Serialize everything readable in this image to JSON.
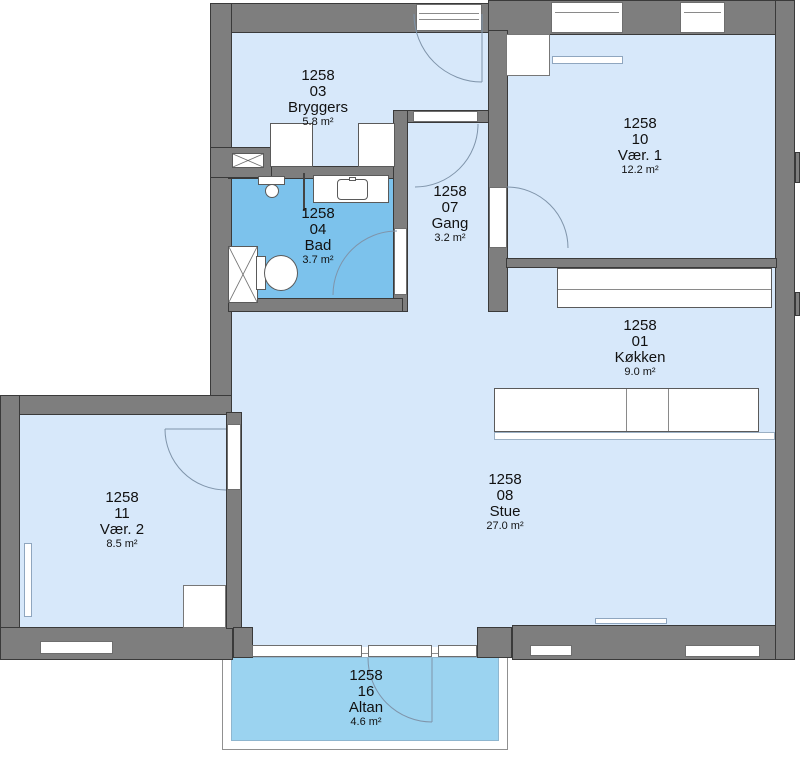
{
  "rooms": [
    {
      "building": "1258",
      "number": "03",
      "name": "Bryggers",
      "area": "5.8 m²"
    },
    {
      "building": "1258",
      "number": "10",
      "name": "Vær. 1",
      "area": "12.2 m²"
    },
    {
      "building": "1258",
      "number": "07",
      "name": "Gang",
      "area": "3.2 m²"
    },
    {
      "building": "1258",
      "number": "04",
      "name": "Bad",
      "area": "3.7 m²"
    },
    {
      "building": "1258",
      "number": "01",
      "name": "Køkken",
      "area": "9.0 m²"
    },
    {
      "building": "1258",
      "number": "08",
      "name": "Stue",
      "area": "27.0 m²"
    },
    {
      "building": "1258",
      "number": "11",
      "name": "Vær. 2",
      "area": "8.5 m²"
    },
    {
      "building": "1258",
      "number": "16",
      "name": "Altan",
      "area": "4.6 m²"
    }
  ],
  "colors": {
    "wall": "#7e7e7e",
    "wall_outline": "#3a3a3a",
    "room_fill": "#d7e8fa",
    "bathroom_fill": "#7cc2ec",
    "balcony_fill": "#9bd3f0",
    "door_arc": "#7f94aa",
    "fixture_outline": "#5a5a5a",
    "opening_outline": "#6e6e6e",
    "label_color": "#111111"
  }
}
